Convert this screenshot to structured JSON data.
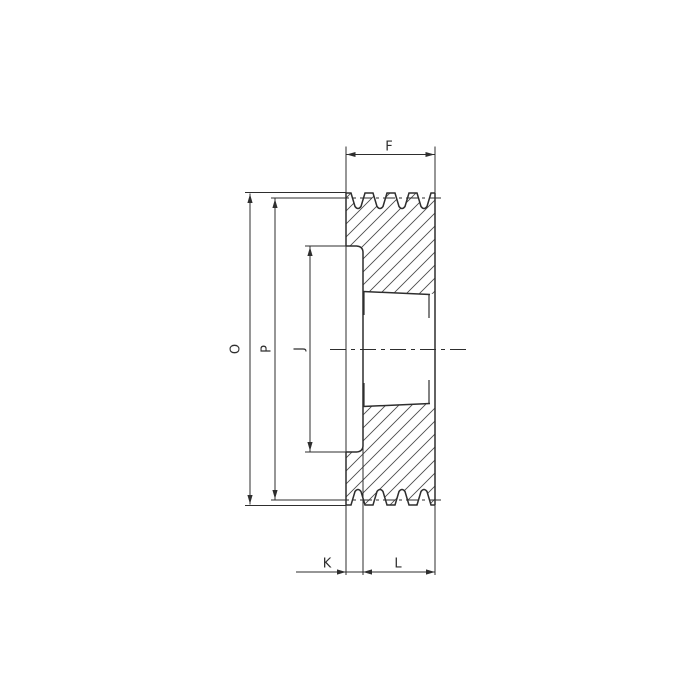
{
  "drawing": {
    "title": "pulley-cross-section",
    "colors": {
      "background": "#ffffff",
      "line": "#2e2e2e",
      "hatch": "#4a4a4a"
    },
    "dimensions": {
      "F": {
        "label": "F"
      },
      "O": {
        "label": "O"
      },
      "P": {
        "label": "P"
      },
      "J": {
        "label": "J"
      },
      "K": {
        "label": "K"
      },
      "L": {
        "label": "L"
      }
    }
  }
}
